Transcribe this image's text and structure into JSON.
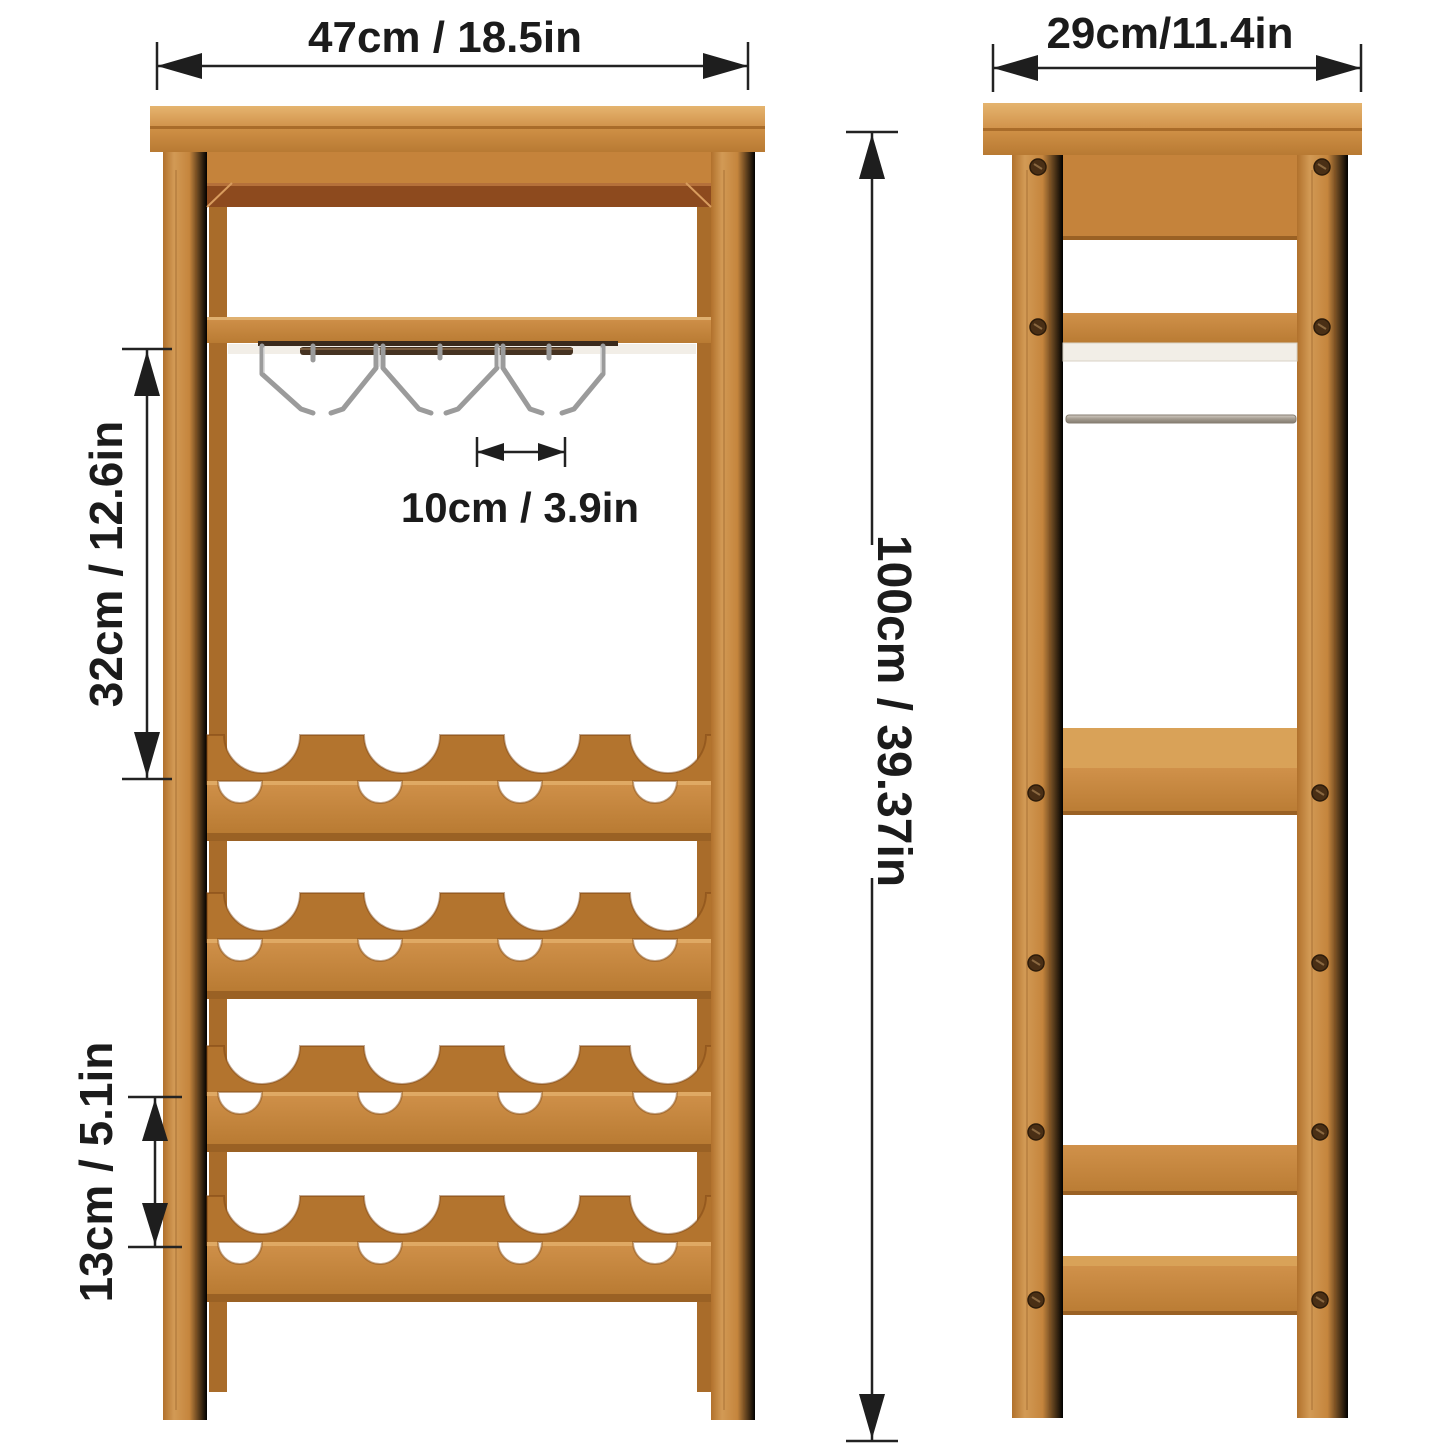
{
  "page": {
    "background": "#ffffff",
    "type": "product-dimension-diagram",
    "product": "Bamboo wine rack with stemware glass hangers, front and side views"
  },
  "views": {
    "front": {
      "name": "front-view",
      "bottle_rows": 4,
      "bottle_slots_per_row": 4,
      "stemware_hangers": 6
    },
    "side": {
      "name": "side-view"
    }
  },
  "dimensions": {
    "front_width": "47cm / 18.5in",
    "side_depth": "29cm/11.4in",
    "glass_rack_height": "32cm / 12.6in",
    "hanger_spacing": "10cm / 3.9in",
    "overall_height": "100cm / 39.37in",
    "row_gap": "13cm / 5.1in"
  },
  "colors": {
    "wood_light": "#dca55d",
    "wood_mid": "#c8863f",
    "wood_dark": "#a86a2e",
    "rail_dark": "#8d4a1e",
    "shelf_white": "#f2eee7",
    "metal_gray": "#9b9b9b",
    "annotation": "#1e1e1e"
  }
}
